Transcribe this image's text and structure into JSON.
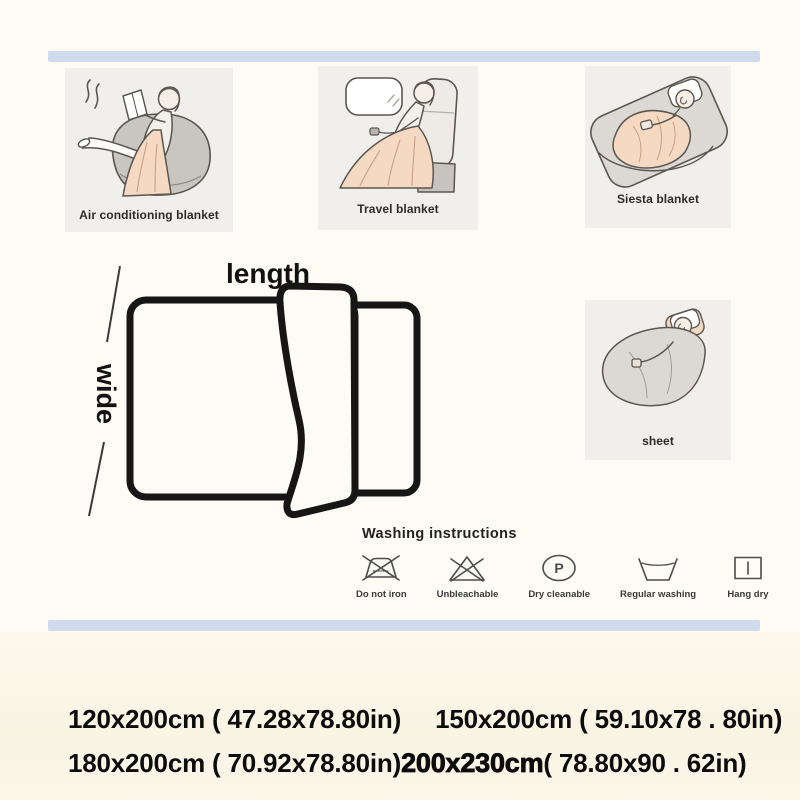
{
  "colors": {
    "background": "#fdfbf4",
    "divider_bar": "#cfdaec",
    "panel_background": "#f1efec",
    "blanket_peach": "#f5d9c2",
    "gray_furniture": "#c9c5c0",
    "line_art_outline": "#5b564f",
    "diagram_outline": "#161616"
  },
  "panels": {
    "aircon": {
      "label": "Air conditioning blanket"
    },
    "travel": {
      "label": "Travel blanket"
    },
    "siesta": {
      "label": "Siesta blanket"
    },
    "sheet": {
      "label": "sheet"
    }
  },
  "diagram": {
    "length": "length",
    "wide": "wide"
  },
  "washing": {
    "title": "Washing instructions",
    "dry_clean_letter": "P",
    "items": [
      {
        "label": "Do not iron",
        "icon": "do-not-iron-icon"
      },
      {
        "label": "Unbleachable",
        "icon": "no-bleach-icon"
      },
      {
        "label": "Dry cleanable",
        "icon": "dry-clean-icon"
      },
      {
        "label": "Regular washing",
        "icon": "wash-tub-icon"
      },
      {
        "label": "Hang dry",
        "icon": "hang-dry-icon"
      }
    ]
  },
  "sizes": {
    "row1": [
      {
        "text": "120x200cm ( 47.28x78.80in)"
      },
      {
        "text": "150x200cm ( 59.10x78 . 80in)"
      }
    ],
    "row2_normal": "180x200cm ( 70.92x78.80in)",
    "row2_bold": "200x230cm",
    "row2_rest": "( 78.80x90 . 62in)"
  }
}
